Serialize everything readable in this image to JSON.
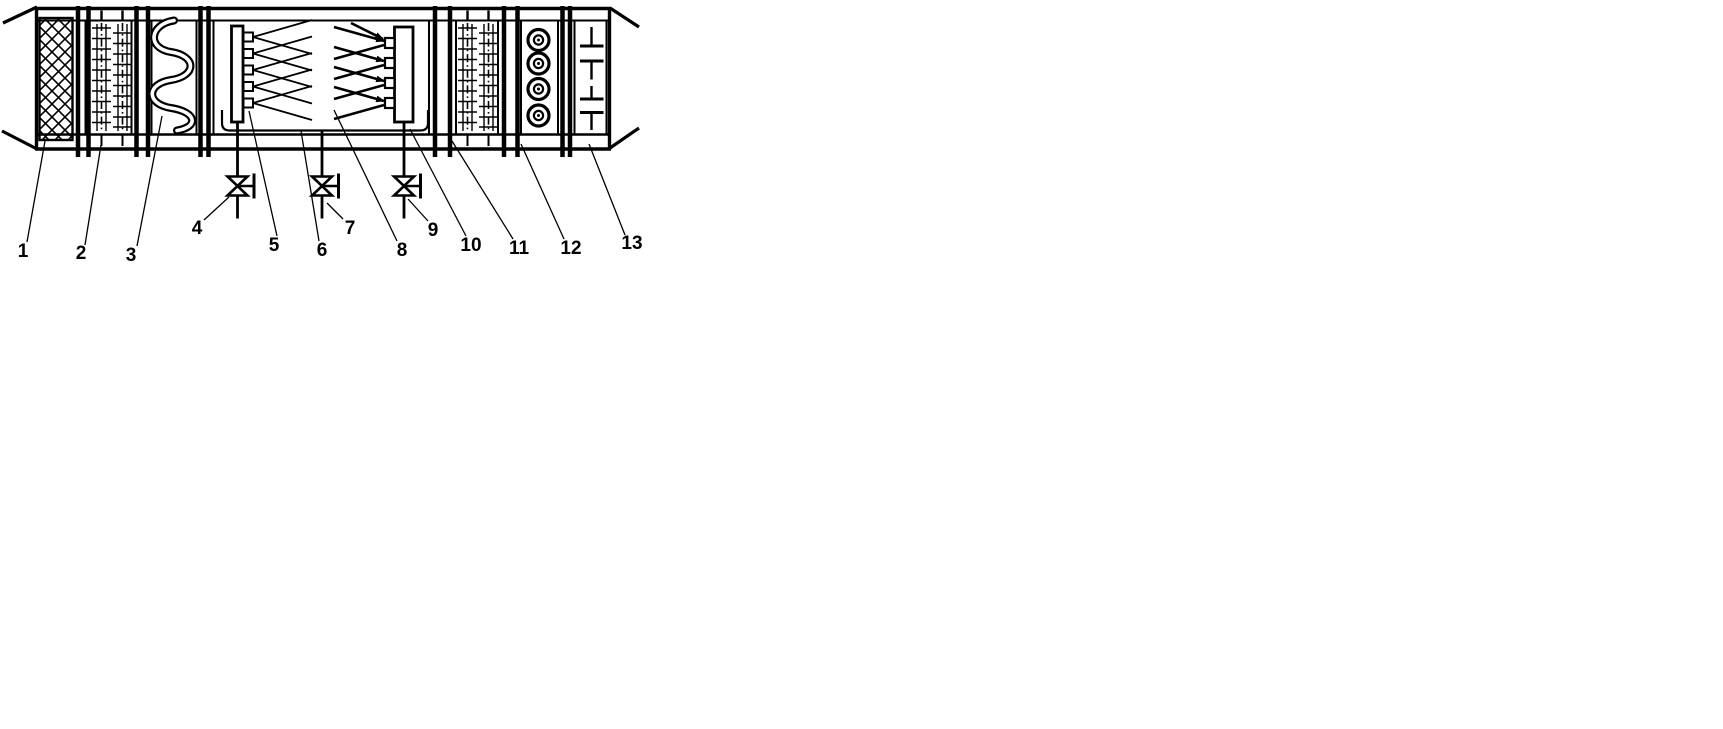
{
  "canvas": {
    "width": 1723,
    "height": 729,
    "background_color": "#ffffff",
    "line_color": "#000000"
  },
  "diagram": {
    "type": "air-handling-unit-schematic",
    "callouts": [
      {
        "text": "1",
        "component": "mesh-filter"
      },
      {
        "text": "2",
        "component": "finned-coil-first"
      },
      {
        "text": "3",
        "component": "serpentine-heater"
      },
      {
        "text": "4",
        "component": "valve-left"
      },
      {
        "text": "5",
        "component": "spray-header-left"
      },
      {
        "text": "6",
        "component": "drain-pan"
      },
      {
        "text": "7",
        "component": "valve-middle"
      },
      {
        "text": "8",
        "component": "spray-chamber"
      },
      {
        "text": "9",
        "component": "valve-right"
      },
      {
        "text": "10",
        "component": "spray-header-right"
      },
      {
        "text": "11",
        "component": "finned-coil-second"
      },
      {
        "text": "12",
        "component": "eliminator-section"
      },
      {
        "text": "13",
        "component": "outlet-section"
      }
    ]
  }
}
